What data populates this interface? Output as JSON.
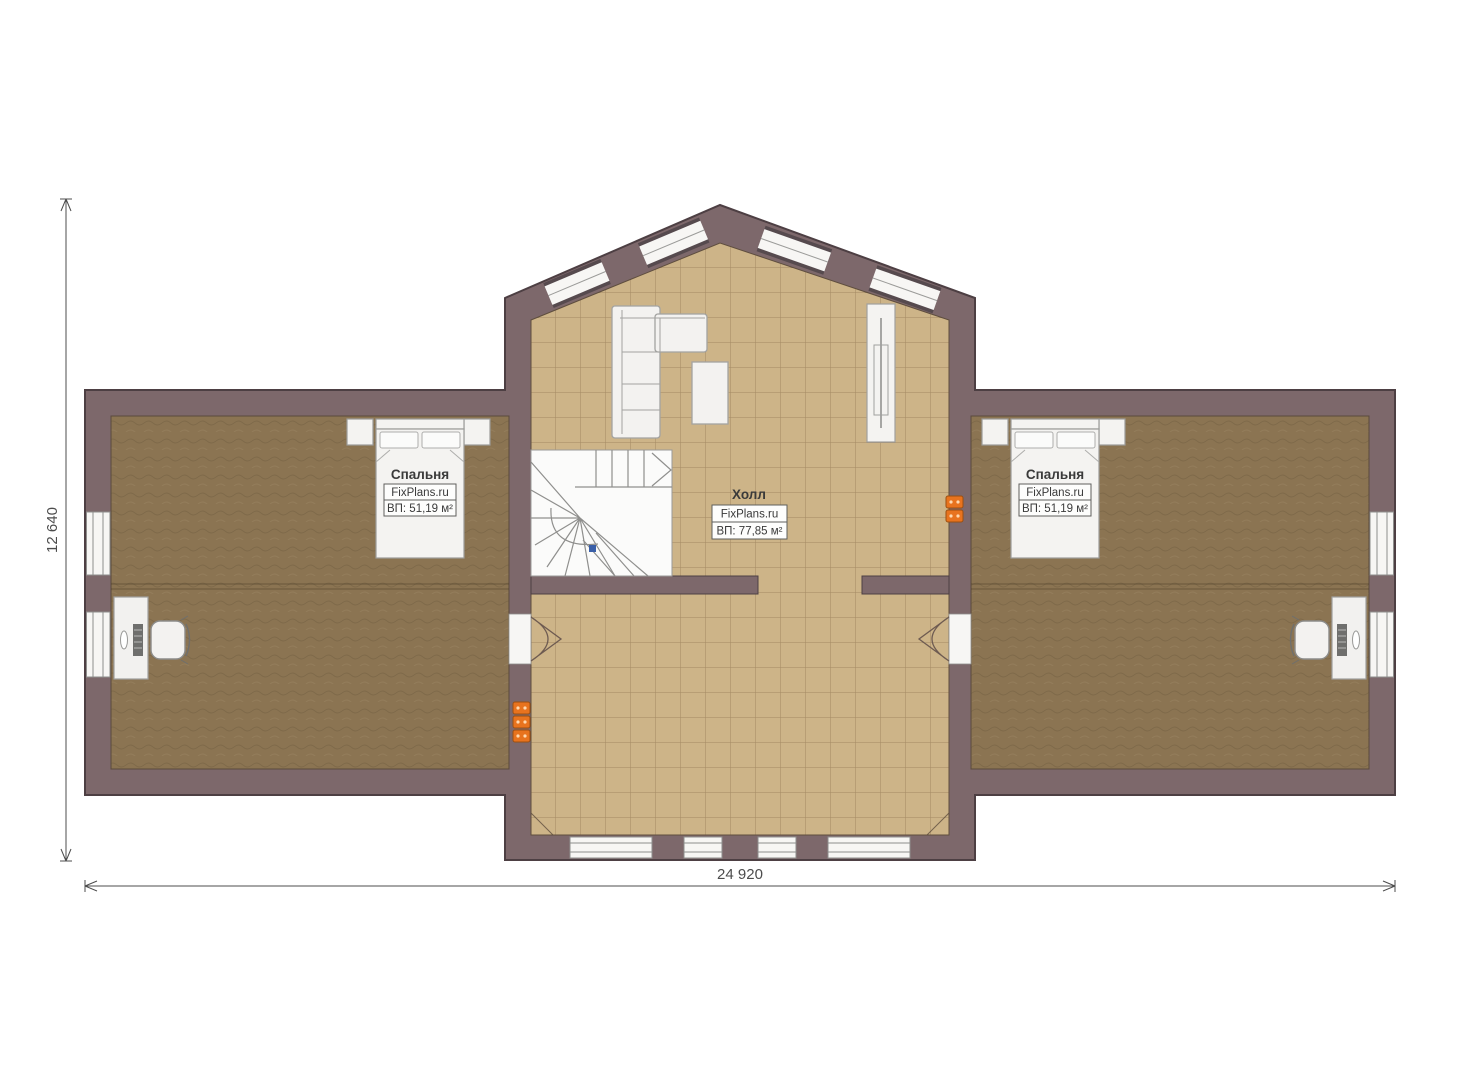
{
  "plan": {
    "title": "floor-plan",
    "dimensions": {
      "width_label": "24 920",
      "height_label": "12 640"
    },
    "rooms": [
      {
        "id": "bedroom-left",
        "name": "Спальня",
        "brand": "FixPlans.ru",
        "area": "ВП: 51,19 м²"
      },
      {
        "id": "hall",
        "name": "Холл",
        "brand": "FixPlans.ru",
        "area": "ВП: 77,85 м²"
      },
      {
        "id": "bedroom-right",
        "name": "Спальня",
        "brand": "FixPlans.ru",
        "area": "ВП: 51,19 м²"
      }
    ],
    "colors": {
      "wall": "#7d686b",
      "hall_floor": "#cdb488",
      "bedroom_floor": "#8b7452",
      "socket_orange": "#e8731e",
      "stair_marker_blue": "#3a5fa8"
    },
    "icons": {
      "stair_direction": "chevron-right",
      "door_swing": "arc",
      "outlet": "power-outlet"
    }
  }
}
